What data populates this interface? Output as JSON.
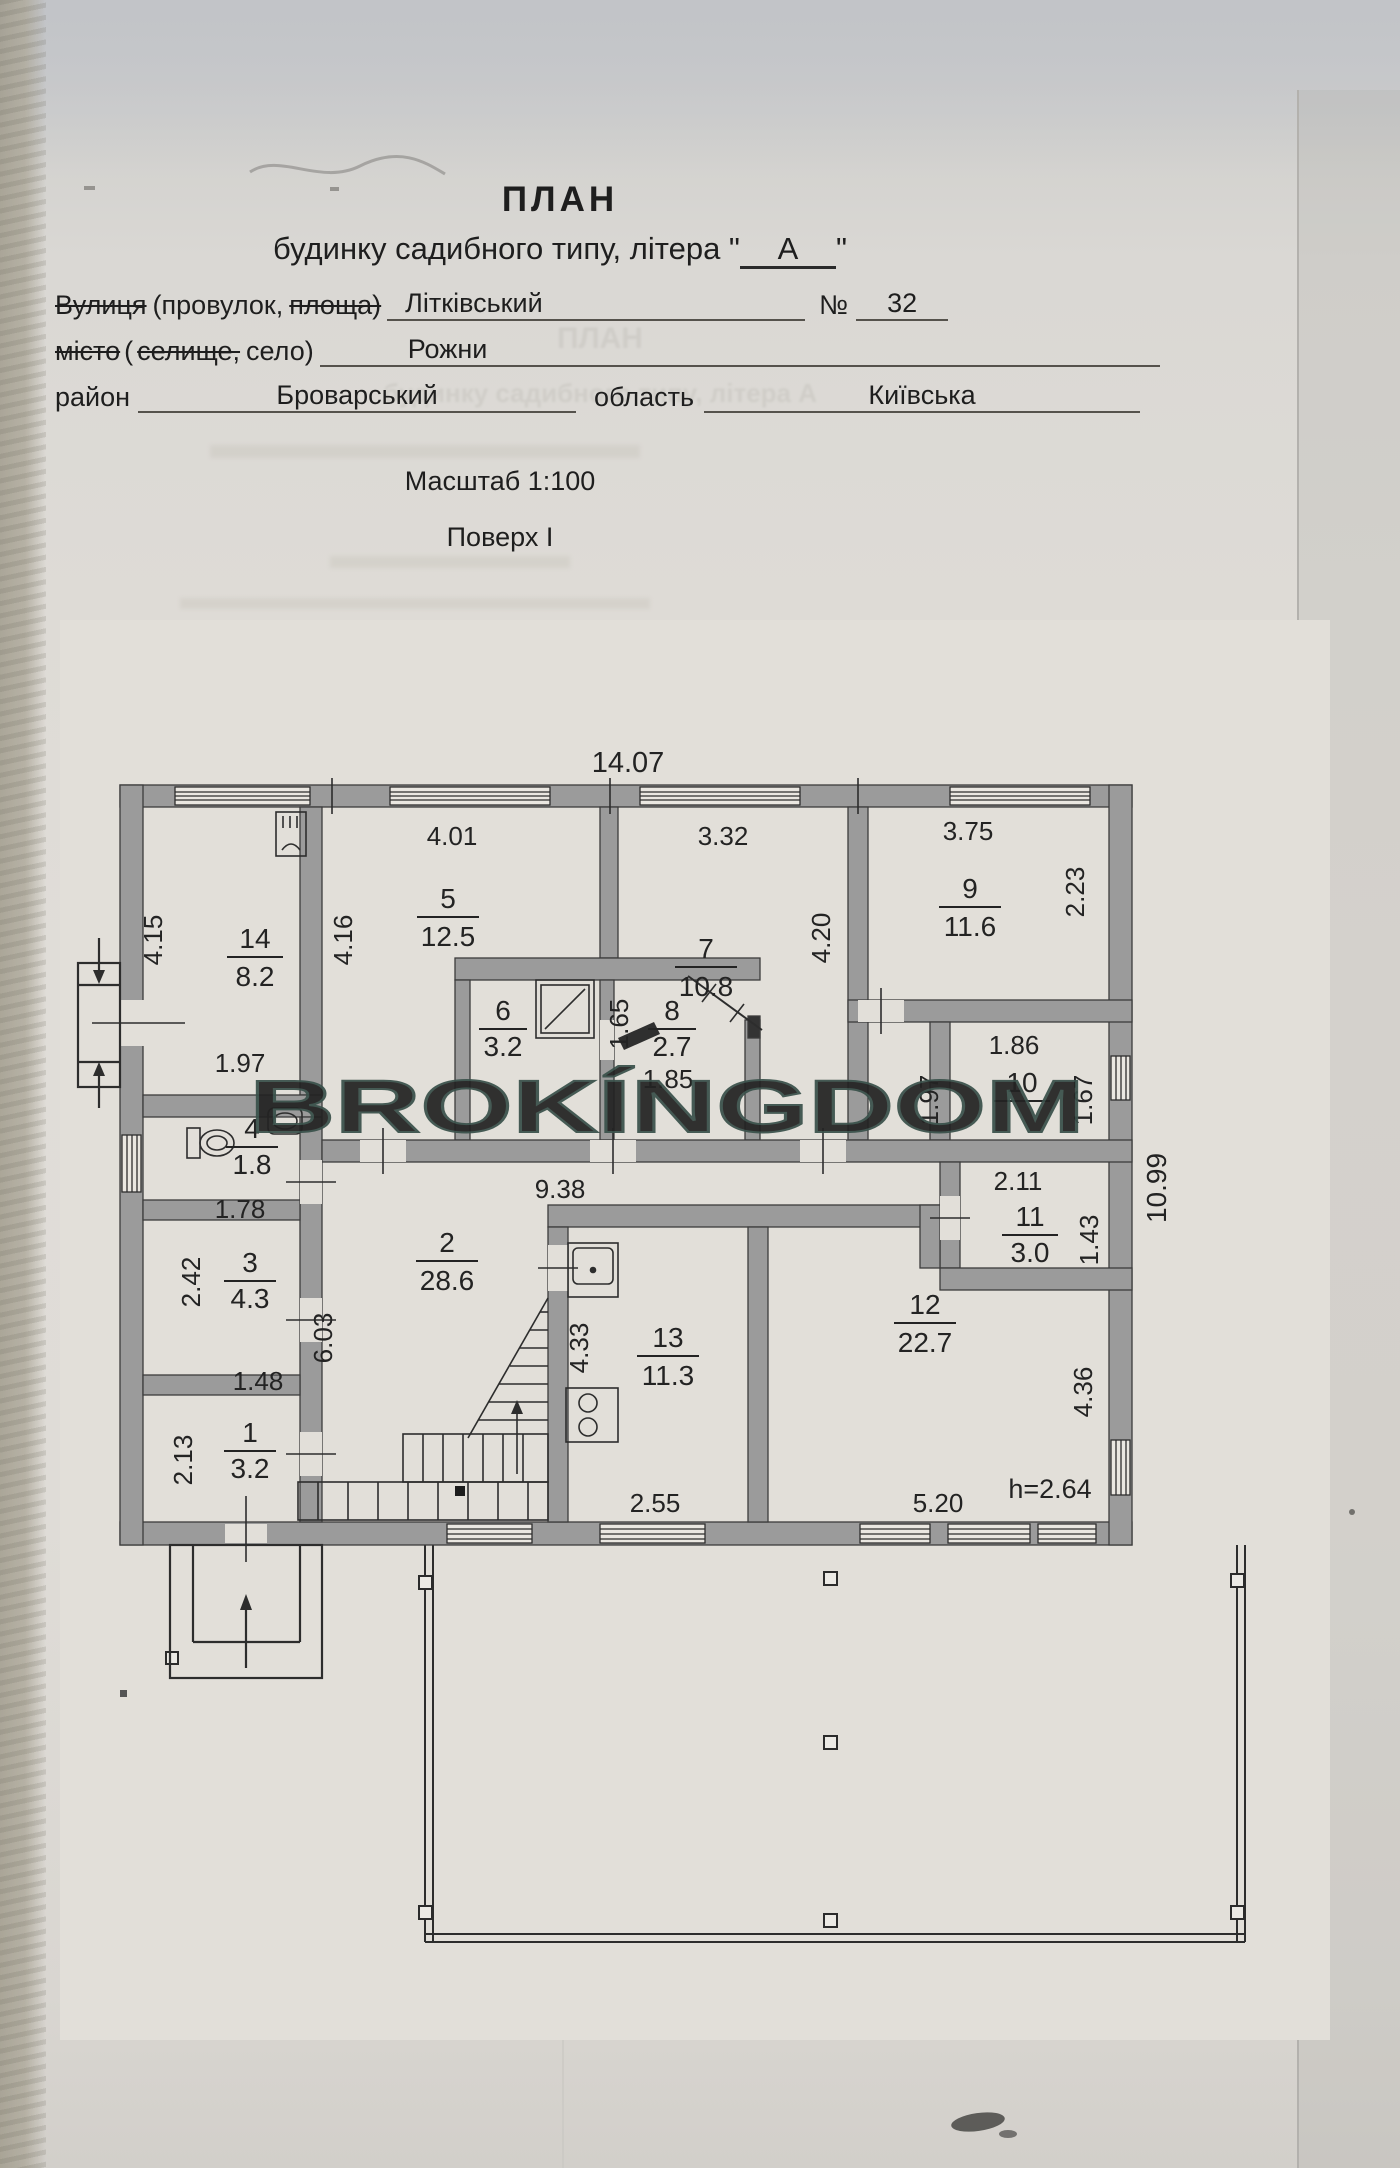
{
  "header": {
    "title": "ПЛАН",
    "subtitle_before": "будинку садибного типу, літера \"",
    "letter": "А",
    "subtitle_after": "\"",
    "street_struck": "Вулиця",
    "street_mid": "(провулок,",
    "street_struck2": "площа)",
    "street_value": "Літківський",
    "no_label": "№",
    "no_value": "32",
    "city_struck": "місто",
    "city_open": "(",
    "city_struck2": "селище,",
    "city_end": "село)",
    "city_value": "Рожни",
    "district_label": "район",
    "district_value": "Броварський",
    "oblast_label": "область",
    "oblast_value": "Київська",
    "scale_line": "Масштаб 1:100",
    "floor_line": "Поверх I"
  },
  "ghost": {
    "line1": "ПЛАН",
    "line2": "будинку садибного типу, літера А"
  },
  "watermark": {
    "text": "BROKÍNGDOM",
    "color": "#3A514B"
  },
  "plan": {
    "rooms": {
      "r1": {
        "number": "1",
        "area": "3.2"
      },
      "r2": {
        "number": "2",
        "area": "28.6"
      },
      "r3": {
        "number": "3",
        "area": "4.3"
      },
      "r4": {
        "number": "4",
        "area": "1.8"
      },
      "r5": {
        "number": "5",
        "area": "12.5"
      },
      "r6": {
        "number": "6",
        "area": "3.2"
      },
      "r7": {
        "number": "7",
        "area": "10.8"
      },
      "r8": {
        "number": "8",
        "area": "2.7"
      },
      "r9": {
        "number": "9",
        "area": "11.6"
      },
      "r10": {
        "number": "10",
        "area": ""
      },
      "r11": {
        "number": "11",
        "area": "3.0"
      },
      "r12": {
        "number": "12",
        "area": "22.7"
      },
      "r13": {
        "number": "13",
        "area": "11.3"
      },
      "r14": {
        "number": "14",
        "area": "8.2"
      }
    },
    "dims": {
      "top_width": "14.07",
      "right_height": "10.99",
      "ceiling": "h=2.64",
      "w5": "4.01",
      "w7": "3.32",
      "w9": "3.75",
      "h14": "4.15",
      "h5": "4.16",
      "h7": "4.20",
      "h9": "2.23",
      "b14": "1.97",
      "w10": "1.86",
      "h10": "1.67",
      "l10": "1.97",
      "w11": "2.11",
      "h11": "1.43",
      "corridor": "9.38",
      "h2": "6.03",
      "h8": "1.65",
      "b8": "1.85",
      "w3": "1.78",
      "h3": "2.42",
      "w1": "1.48",
      "h1": "2.13",
      "h13": "4.33",
      "b13": "2.55",
      "b12": "5.20",
      "h12": "4.36"
    }
  }
}
